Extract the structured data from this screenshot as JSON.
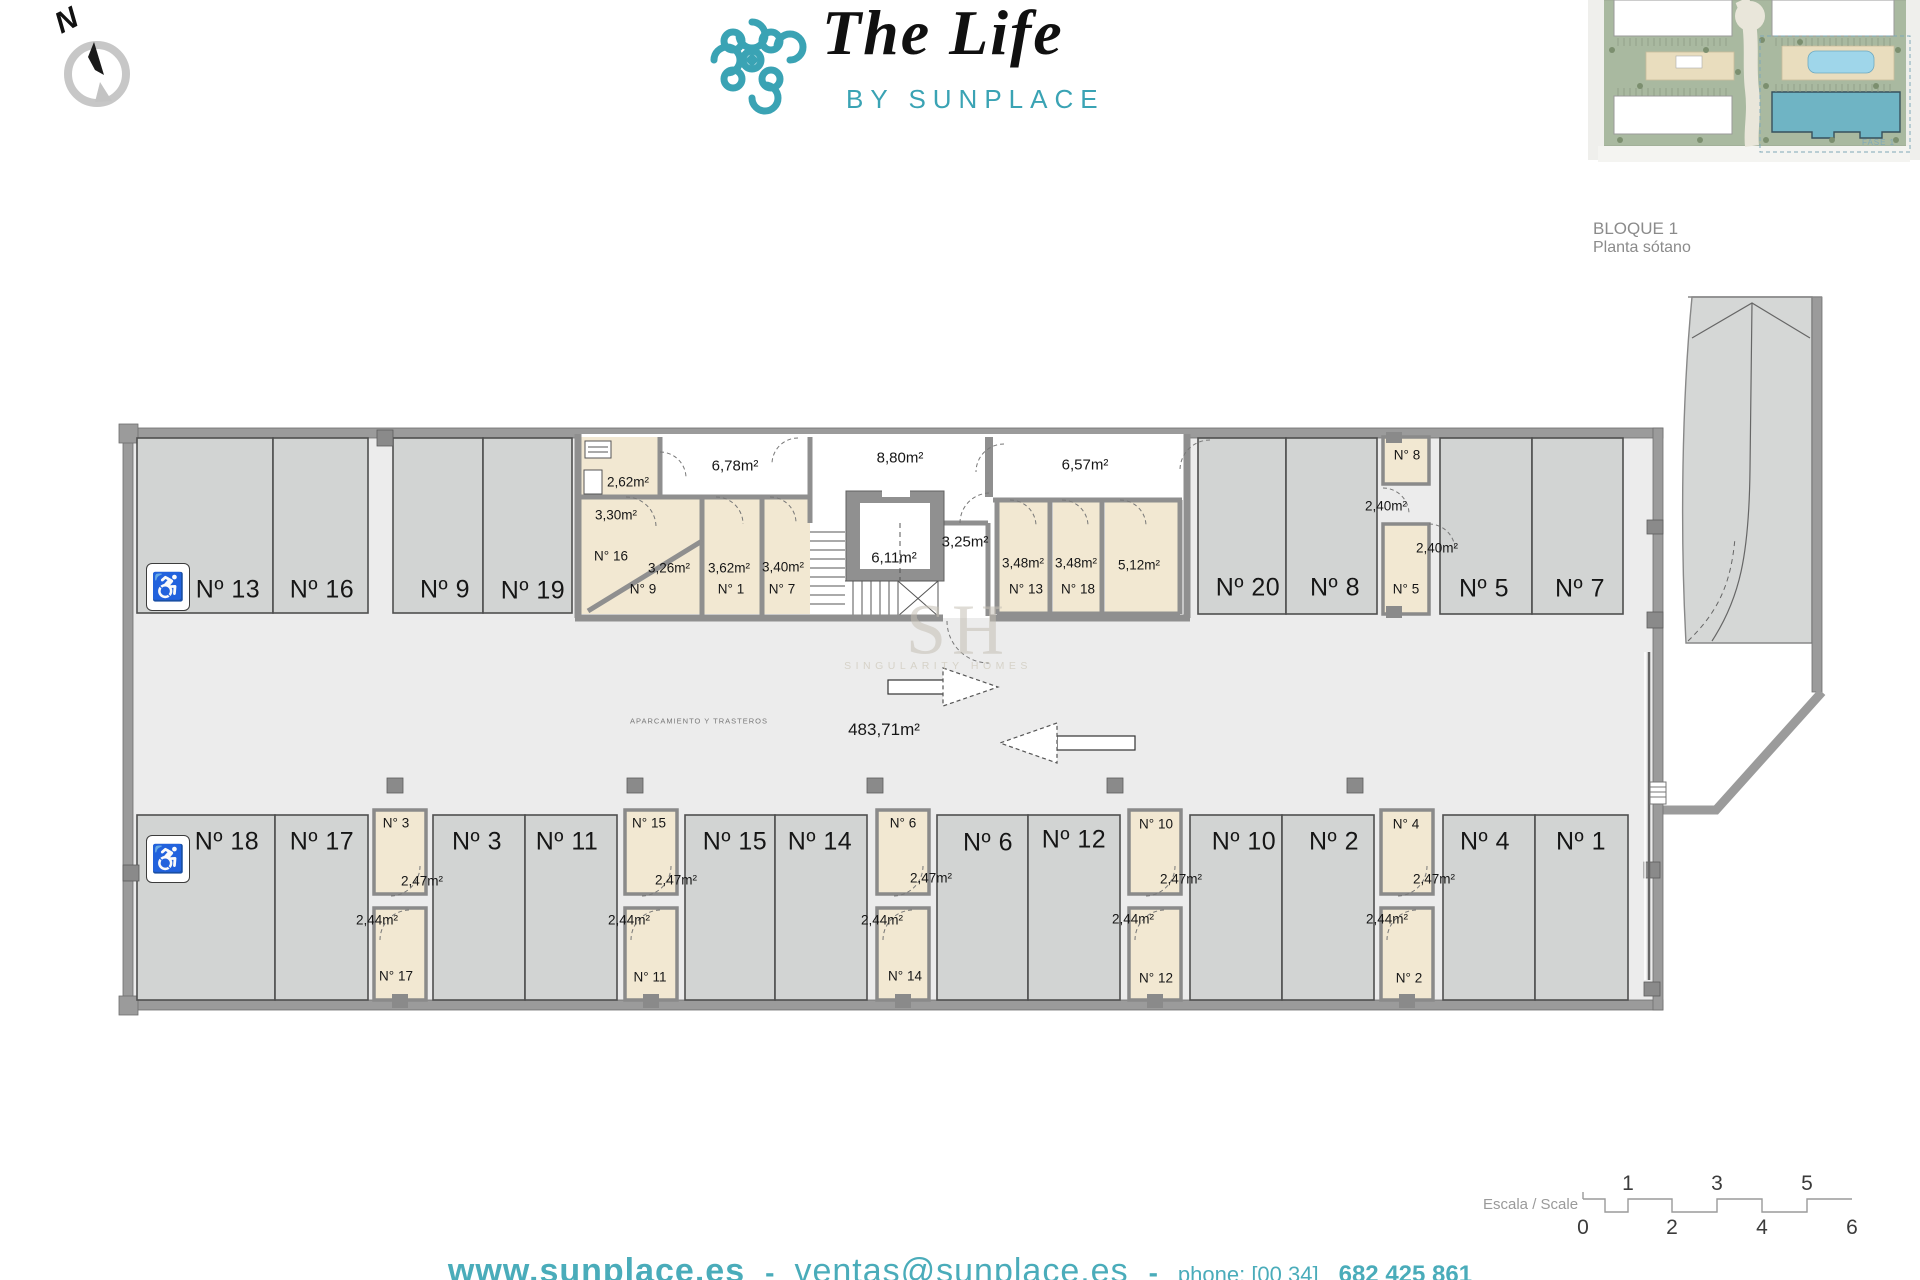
{
  "header": {
    "compass_label": "N",
    "logo_title": "The Life",
    "logo_subtitle": "BY SUNPLACE",
    "block_title": "BLOQUE 1",
    "block_subtitle": "Planta sótano",
    "siteplan_phase_label": "FASE 1"
  },
  "colors": {
    "brand_teal": "#3aa3b4",
    "footer_teal": "#4aacba",
    "wall_gray": "#9b9b9b",
    "parking_fill": "#d2d4d3",
    "storage_beige": "#f2e8d2",
    "floor_gray": "#ececec"
  },
  "watermark": {
    "initials": "SH",
    "name": "SINGULARITY HOMES"
  },
  "plan": {
    "area_total": "483,71m²",
    "area_note": "APARCAMIENTO Y TRASTEROS",
    "labels": [
      {
        "t": "Nº 13",
        "x": 228,
        "y": 590,
        "c": "p"
      },
      {
        "t": "Nº 16",
        "x": 322,
        "y": 590,
        "c": "p"
      },
      {
        "t": "Nº 9",
        "x": 445,
        "y": 590,
        "c": "p"
      },
      {
        "t": "Nº 19",
        "x": 533,
        "y": 591,
        "c": "p"
      },
      {
        "t": "Nº 20",
        "x": 1248,
        "y": 588,
        "c": "p"
      },
      {
        "t": "Nº 8",
        "x": 1335,
        "y": 588,
        "c": "p"
      },
      {
        "t": "Nº 5",
        "x": 1484,
        "y": 589,
        "c": "p"
      },
      {
        "t": "Nº 7",
        "x": 1580,
        "y": 589,
        "c": "p"
      },
      {
        "t": "Nº 18",
        "x": 227,
        "y": 842,
        "c": "p"
      },
      {
        "t": "Nº 17",
        "x": 322,
        "y": 842,
        "c": "p"
      },
      {
        "t": "Nº 3",
        "x": 477,
        "y": 842,
        "c": "p"
      },
      {
        "t": "Nº 11",
        "x": 567,
        "y": 842,
        "c": "p"
      },
      {
        "t": "Nº 15",
        "x": 735,
        "y": 842,
        "c": "p"
      },
      {
        "t": "Nº 14",
        "x": 820,
        "y": 842,
        "c": "p"
      },
      {
        "t": "Nº 6",
        "x": 988,
        "y": 843,
        "c": "p"
      },
      {
        "t": "Nº 12",
        "x": 1074,
        "y": 840,
        "c": "p"
      },
      {
        "t": "Nº 10",
        "x": 1244,
        "y": 842,
        "c": "p"
      },
      {
        "t": "Nº 2",
        "x": 1334,
        "y": 842,
        "c": "p"
      },
      {
        "t": "Nº 4",
        "x": 1485,
        "y": 842,
        "c": "p"
      },
      {
        "t": "Nº 1",
        "x": 1581,
        "y": 842,
        "c": "p"
      },
      {
        "t": "2,62m²",
        "x": 628,
        "y": 482,
        "c": "s"
      },
      {
        "t": "3,30m²",
        "x": 616,
        "y": 515,
        "c": "s"
      },
      {
        "t": "N° 16",
        "x": 611,
        "y": 556,
        "c": "s"
      },
      {
        "t": "3,26m²",
        "x": 669,
        "y": 568,
        "c": "s"
      },
      {
        "t": "N° 9",
        "x": 643,
        "y": 589,
        "c": "s"
      },
      {
        "t": "3,62m²",
        "x": 729,
        "y": 568,
        "c": "s"
      },
      {
        "t": "N° 1",
        "x": 731,
        "y": 589,
        "c": "s"
      },
      {
        "t": "3,40m²",
        "x": 783,
        "y": 567,
        "c": "s"
      },
      {
        "t": "N° 7",
        "x": 782,
        "y": 589,
        "c": "s"
      },
      {
        "t": "6,78m²",
        "x": 735,
        "y": 466,
        "c": "a"
      },
      {
        "t": "8,80m²",
        "x": 900,
        "y": 458,
        "c": "a"
      },
      {
        "t": "6,11m²",
        "x": 894,
        "y": 558,
        "c": "a"
      },
      {
        "t": "3,25m²",
        "x": 965,
        "y": 542,
        "c": "a"
      },
      {
        "t": "6,57m²",
        "x": 1085,
        "y": 465,
        "c": "a"
      },
      {
        "t": "3,48m²",
        "x": 1023,
        "y": 563,
        "c": "s"
      },
      {
        "t": "N° 13",
        "x": 1026,
        "y": 589,
        "c": "s"
      },
      {
        "t": "3,48m²",
        "x": 1076,
        "y": 563,
        "c": "s"
      },
      {
        "t": "N° 18",
        "x": 1078,
        "y": 589,
        "c": "s"
      },
      {
        "t": "5,12m²",
        "x": 1139,
        "y": 565,
        "c": "s"
      },
      {
        "t": "N° 8",
        "x": 1407,
        "y": 455,
        "c": "s"
      },
      {
        "t": "2,40m²",
        "x": 1386,
        "y": 506,
        "c": "s"
      },
      {
        "t": "2,40m²",
        "x": 1437,
        "y": 548,
        "c": "s"
      },
      {
        "t": "N° 5",
        "x": 1406,
        "y": 589,
        "c": "s"
      },
      {
        "t": "N° 3",
        "x": 396,
        "y": 823,
        "c": "s"
      },
      {
        "t": "2,47m²",
        "x": 422,
        "y": 881,
        "c": "s"
      },
      {
        "t": "2,44m²",
        "x": 377,
        "y": 920,
        "c": "s"
      },
      {
        "t": "N° 17",
        "x": 396,
        "y": 976,
        "c": "s"
      },
      {
        "t": "N° 15",
        "x": 649,
        "y": 823,
        "c": "s"
      },
      {
        "t": "2,47m²",
        "x": 676,
        "y": 880,
        "c": "s"
      },
      {
        "t": "2,44m²",
        "x": 629,
        "y": 920,
        "c": "s"
      },
      {
        "t": "N° 11",
        "x": 650,
        "y": 977,
        "c": "s"
      },
      {
        "t": "N° 6",
        "x": 903,
        "y": 823,
        "c": "s"
      },
      {
        "t": "2,47m²",
        "x": 931,
        "y": 878,
        "c": "s"
      },
      {
        "t": "2,44m²",
        "x": 882,
        "y": 920,
        "c": "s"
      },
      {
        "t": "N° 14",
        "x": 905,
        "y": 976,
        "c": "s"
      },
      {
        "t": "N° 10",
        "x": 1156,
        "y": 824,
        "c": "s"
      },
      {
        "t": "2,47m²",
        "x": 1181,
        "y": 879,
        "c": "s"
      },
      {
        "t": "2,44m²",
        "x": 1133,
        "y": 919,
        "c": "s"
      },
      {
        "t": "N° 12",
        "x": 1156,
        "y": 978,
        "c": "s"
      },
      {
        "t": "N° 4",
        "x": 1406,
        "y": 824,
        "c": "s"
      },
      {
        "t": "2,47m²",
        "x": 1434,
        "y": 879,
        "c": "s"
      },
      {
        "t": "2,44m²",
        "x": 1387,
        "y": 919,
        "c": "s"
      },
      {
        "t": "N° 2",
        "x": 1409,
        "y": 978,
        "c": "s"
      }
    ],
    "accessible_icon": "♿"
  },
  "scalebar": {
    "label": "Escala / Scale",
    "top_numbers": [
      {
        "t": "1",
        "x": 1628
      },
      {
        "t": "3",
        "x": 1717
      },
      {
        "t": "5",
        "x": 1807
      }
    ],
    "bottom_numbers": [
      {
        "t": "0",
        "x": 1583
      },
      {
        "t": "2",
        "x": 1672
      },
      {
        "t": "4",
        "x": 1762
      },
      {
        "t": "6",
        "x": 1852
      }
    ]
  },
  "footer": {
    "website": "www.sunplace.es",
    "separator": "-",
    "email": "ventas@sunplace.es",
    "phone_label": "phone: [00 34]",
    "phone_number": "682 425 861"
  }
}
